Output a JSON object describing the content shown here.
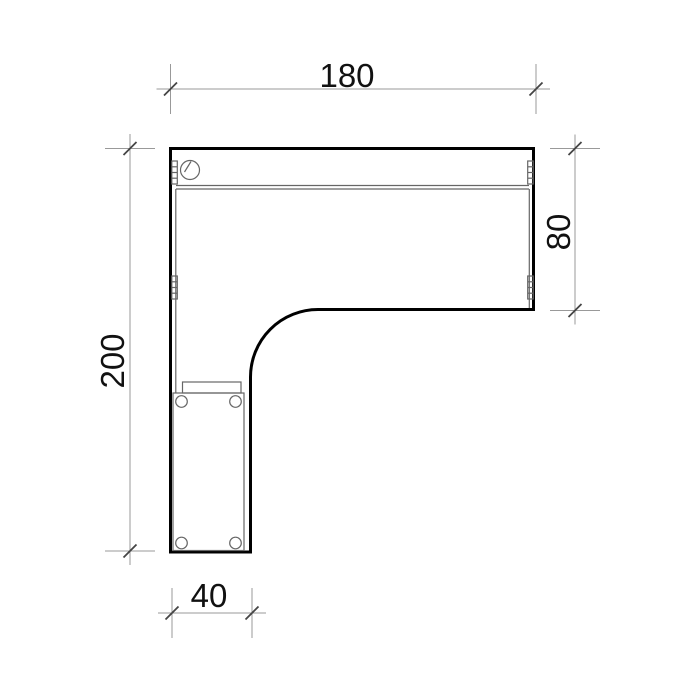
{
  "drawing": {
    "type": "furniture-plan-top-view",
    "dimensions": {
      "top": {
        "label": "180"
      },
      "right": {
        "label": "80"
      },
      "left": {
        "label": "200"
      },
      "bottom": {
        "label": "40"
      }
    },
    "colors": {
      "background": "#ffffff",
      "outline": "#000000",
      "detail_lines": "#666666",
      "dimension_lines": "#999999",
      "dimension_ticks": "#444444",
      "text": "#111111"
    }
  }
}
